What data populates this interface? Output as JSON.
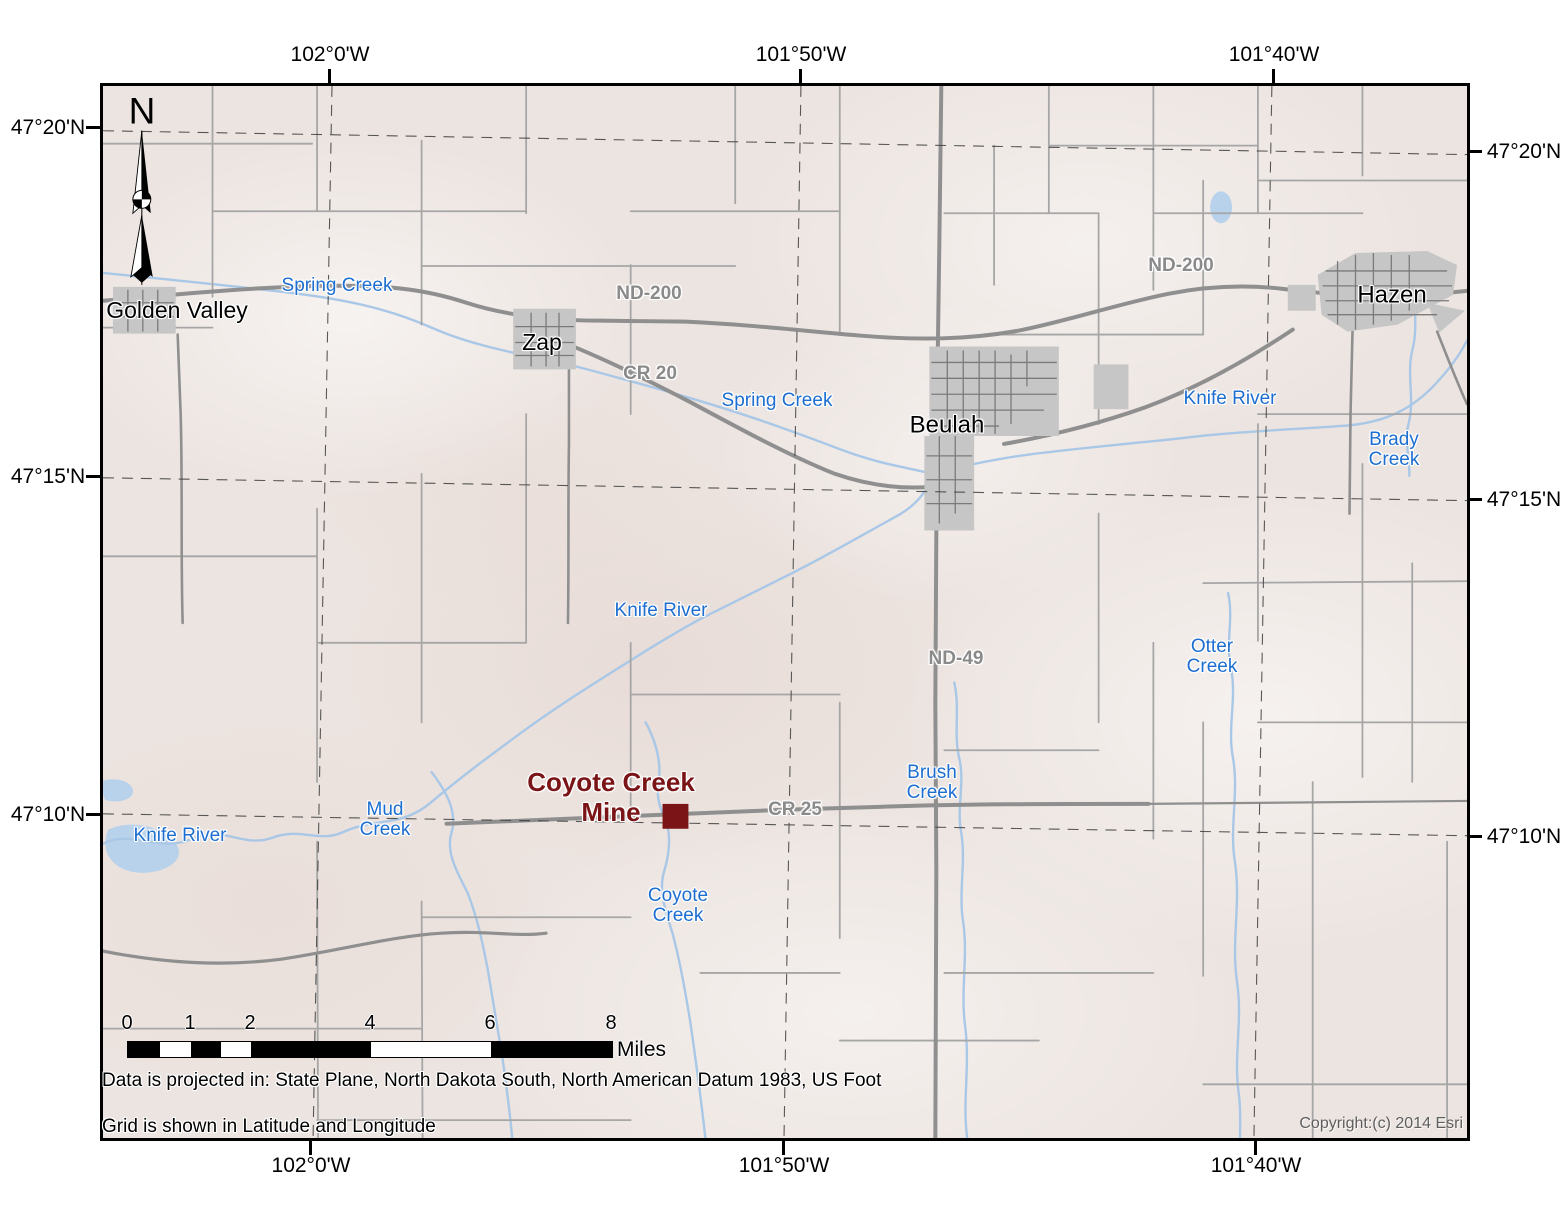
{
  "frame": {
    "axis_top": [
      "102°0'W",
      "101°50'W",
      "101°40'W"
    ],
    "axis_bottom": [
      "102°0'W",
      "101°50'W",
      "101°40'W"
    ],
    "axis_left": [
      "47°20'N",
      "47°15'N",
      "47°10'N"
    ],
    "axis_right": [
      "47°20'N",
      "47°15'N",
      "47°10'N"
    ]
  },
  "north_arrow": {
    "label": "N"
  },
  "places": {
    "golden_valley": "Golden Valley",
    "zap": "Zap",
    "beulah": "Beulah",
    "hazen": "Hazen"
  },
  "mine": {
    "label": "Coyote Creek\nMine"
  },
  "roads": {
    "nd200_west": "ND-200",
    "nd200_east": "ND-200",
    "cr20": "CR 20",
    "nd49": "ND-49",
    "cr25": "CR 25"
  },
  "waters": {
    "spring_creek_west": "Spring Creek",
    "spring_creek_center": "Spring Creek",
    "knife_river_east": "Knife River",
    "knife_river_center": "Knife River",
    "knife_river_southwest": "Knife River",
    "brady_creek": "Brady\nCreek",
    "otter_creek": "Otter\nCreek",
    "brush_creek": "Brush\nCreek",
    "mud_creek": "Mud\nCreek",
    "coyote_creek": "Coyote\nCreek"
  },
  "scalebar": {
    "ticks": [
      "0",
      "1",
      "2",
      "4",
      "6",
      "8"
    ],
    "unit": "Miles"
  },
  "notes": {
    "projection": "Data is projected in: State Plane, North Dakota South, North American Datum 1983, US Foot",
    "grid": "Grid is shown in Latitude and Longitude",
    "copyright": "Copyright:(c) 2014 Esri"
  },
  "colors": {
    "terrain": "#ece4e0",
    "water": "#a9c7e6",
    "water_label": "#1c6ed0",
    "road": "#8f8f8f",
    "road_label": "#8a8a8a",
    "town_fill": "#c6c6c6",
    "mine": "#7b1416"
  }
}
